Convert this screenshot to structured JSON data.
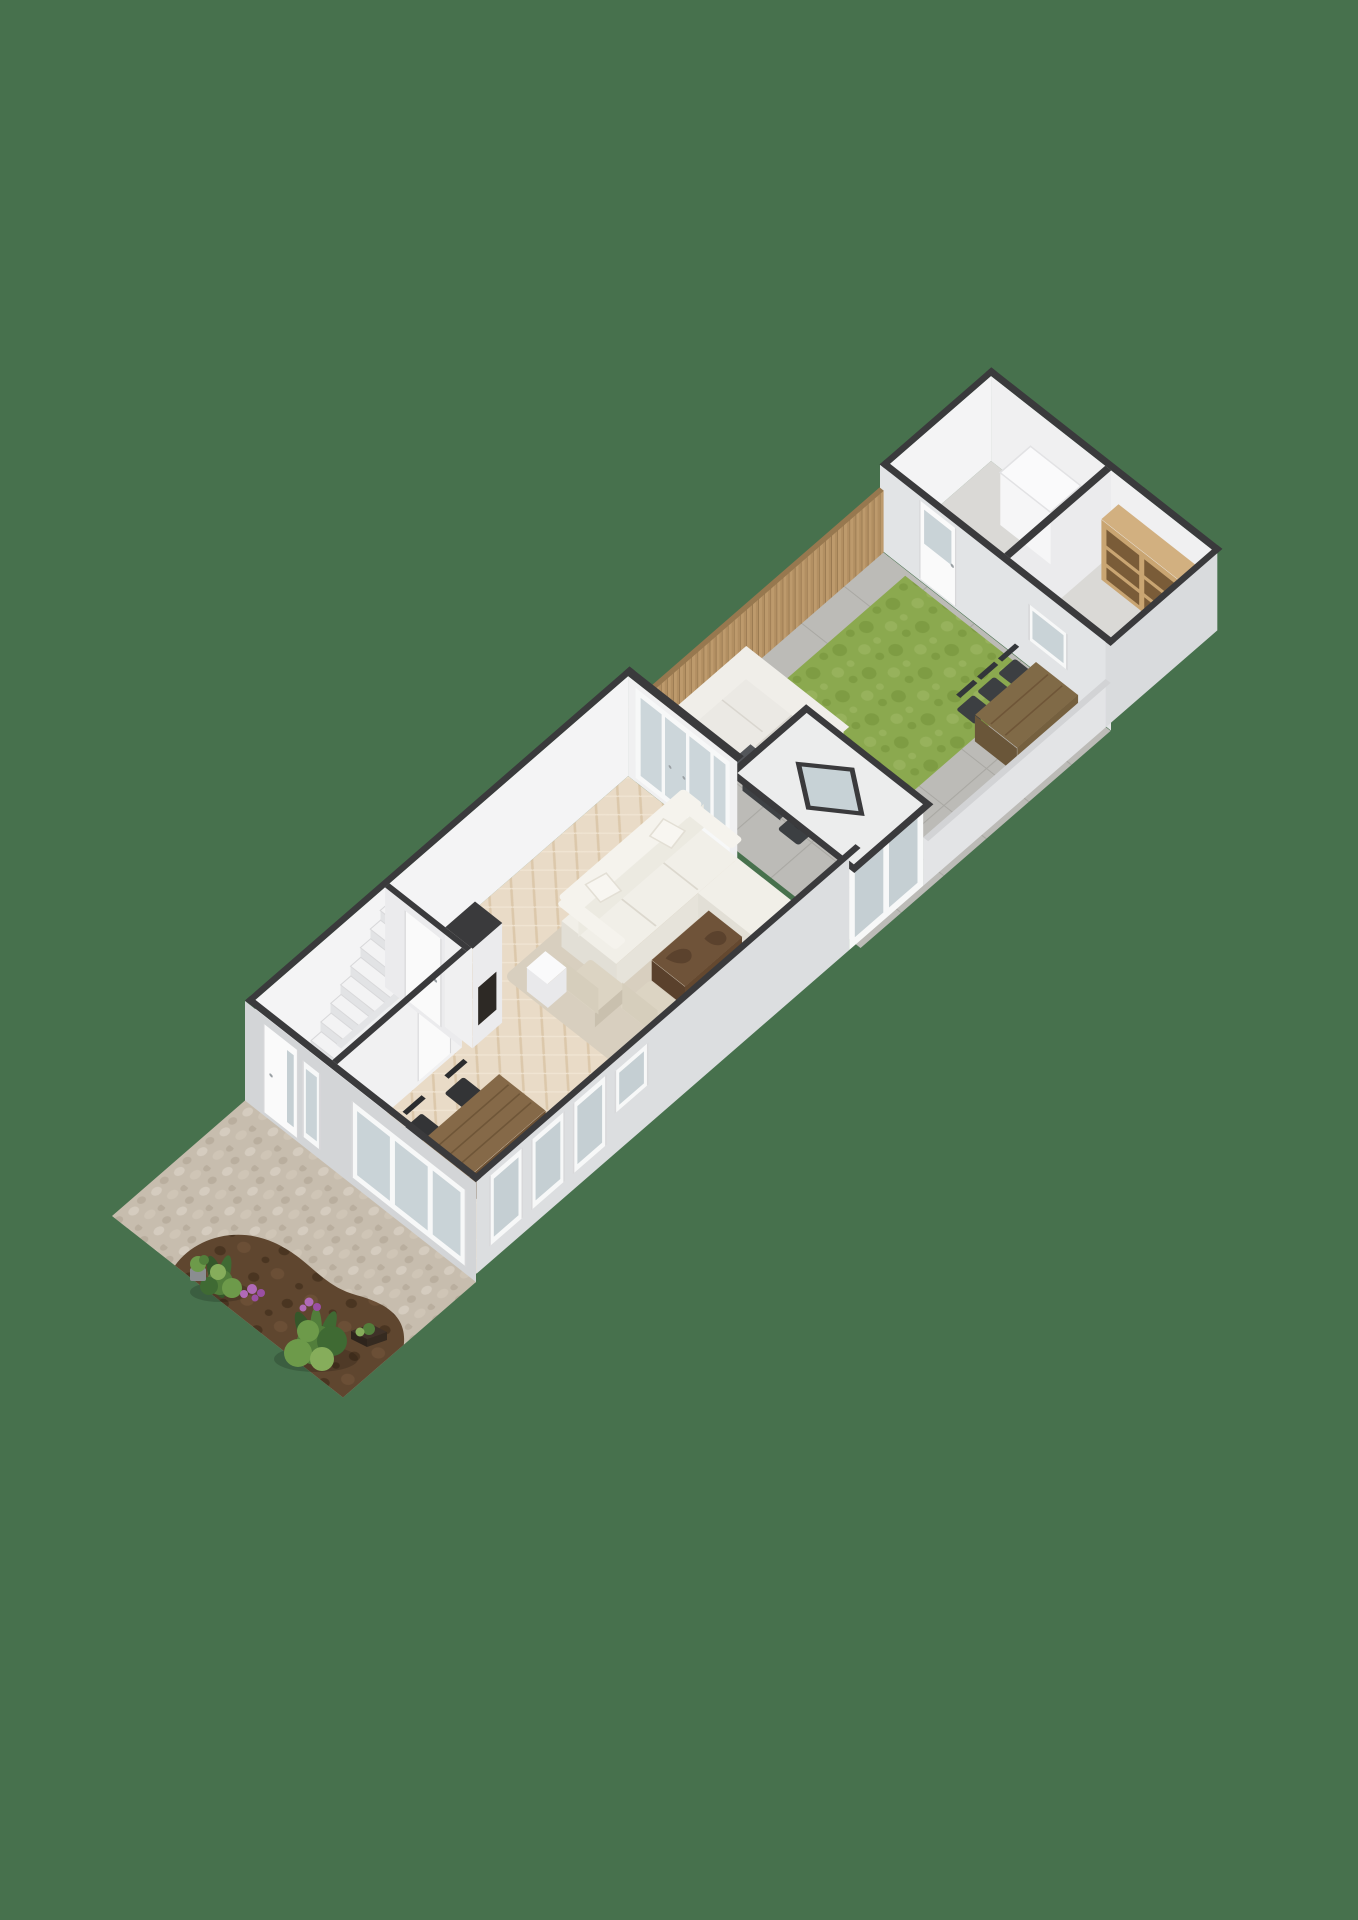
{
  "scene": {
    "kind": "isometric-3d-floorplan-render",
    "floor": "ground-floor",
    "orientation": "plot runs diagonally from front garden (bottom-left) to shed (top-right)",
    "background": "#47714d"
  },
  "objects": {
    "front_garden": [
      "pebble paving",
      "soil bed",
      "plants",
      "purple flowers",
      "planter box"
    ],
    "house": [
      "entry hall",
      "staircase",
      "doormat niche",
      "living room",
      "sectional sofa",
      "coffee table",
      "armchairs",
      "side table",
      "dining table",
      "dining chairs",
      "chimney breast",
      "french doors",
      "rear extension with skylight",
      "front door",
      "windows"
    ],
    "back_garden": [
      "tile terrace",
      "wooden fence",
      "grass rug",
      "outdoor lounge sofa",
      "outdoor lounge table",
      "outdoor chairs",
      "outdoor dining table",
      "outdoor dining chairs",
      "low boundary wall"
    ],
    "shed": [
      "storage room",
      "freezer box",
      "wooden shelving unit",
      "shed door",
      "shed window"
    ]
  },
  "colors": {
    "bg": "#47714d",
    "wallTop": "#3a3a3c",
    "wallWhite": "#f4f4f5",
    "wallInterior2": "#f0f0f1",
    "wallPartition": "#f1f1f2",
    "wallReturn": "#ebebed",
    "wallGrey": "#d3d5d7",
    "wallGreyLight": "#dcdee0",
    "shedFront": "#e2e4e6",
    "shedRight": "#d9dbdd",
    "shedFloor": "#dad9d6",
    "floorWoodBase": "#e9dbc7",
    "floorWoodLine": "#dcc8ab",
    "floorWoodLine2": "#f0e4d2",
    "rug": "#d8cfbf",
    "sofaTop": "#f1efe8",
    "sofaFace": "#e2dfd6",
    "sofaFace2": "#e6e3da",
    "sofaBack": "#f5f3ed",
    "sofaBackFace": "#eceae1",
    "sofaSeam": "#dcd8ce",
    "pillow": "#f8f6f1",
    "pillowEdge": "#e3dfd5",
    "coffeeTop": "#6f5339",
    "coffeeFaceA": "#64482f",
    "coffeeFaceB": "#5a412c",
    "coffeeBlob": "#5b422d",
    "armSeat": "#dcd4c3",
    "armFace": "#c9c0ae",
    "armBack": "#d6cebc",
    "sideTableTop": "#fafafb",
    "sideTableFace": "#e9e9eb",
    "dinTableTop": "#856948",
    "dinTableFaceA": "#6e5234",
    "dinTableFaceB": "#63492e",
    "dinTableLine": "#6f5638",
    "chairDark": "#333436",
    "chairBack": "#2b2c2e",
    "stairTread": "#f3f3f4",
    "stairRiser": "#e2e3e5",
    "balustrade": "#eff0f1",
    "balustradeTop": "#e3e4e6",
    "doormat": "#6a4e38",
    "doorWhite": "#fafafa",
    "doorFrame": "#d8d8da",
    "handle": "#9aa0a4",
    "glass": "#c9d3d7",
    "glassCool": "#c5cfd3",
    "glassDoor": "#ccd6da",
    "frameWhite": "#f7f8f8",
    "tileBase": "#bcbbb7",
    "tileLine": "#a9a8a3",
    "grass1": "#8ba94f",
    "grass2": "#7e9c43",
    "grass3": "#97b25c",
    "fenceWoodBase": "#bd9a6c",
    "fenceWoodAlt": "#b28f62",
    "fenceLine": "#8f7049",
    "fenceTop": "#97784f",
    "lowWall": "#e3e4e6",
    "lowWallTop": "#d2d3d5",
    "loungeBase": "#53565a",
    "loungeCushion": "#ebe9e4",
    "loungeBack": "#f0eee9",
    "loungeSeam": "#d9d6cf",
    "loungeTableTop": "#53575a",
    "loungeTableFaceA": "#45484b",
    "loungeTableFaceB": "#3e4144",
    "outChair": "#3c3f42",
    "outChairBack": "#33363a",
    "outTableTop": "#806a47",
    "outTableFaceA": "#75603f",
    "outTableFaceB": "#6a5639",
    "freezer": "#f6f6f7",
    "freezerSide": "#ebebed",
    "freezerTop": "#fafafb",
    "shelfWood": "#c9a572",
    "shelfSide": "#b08c5d",
    "shelfTop": "#d2b080",
    "shelfDark": "#7a5c38",
    "roof": "#eceded",
    "skylight": "#c7d2d6",
    "pebbleBase": "#c7bdae",
    "pebble1": "#d5ccbf",
    "pebble2": "#b9ae9e",
    "pebble3": "#cfc5b6",
    "soilBase": "#5f462f",
    "soilDark": "#4a3521",
    "soilLight": "#6b4f36",
    "leaf1": "#3f6a33",
    "leaf2": "#527e3b",
    "leaf3": "#6d9a4a",
    "leaf4": "#86ad5b",
    "leafDark": "#35572a",
    "flower": "#b06ab8",
    "flower2": "#9a4fa3",
    "pot": "#8a8d90",
    "planter": "#3f3128",
    "shadow": "rgba(0,0,0,0.16)"
  }
}
